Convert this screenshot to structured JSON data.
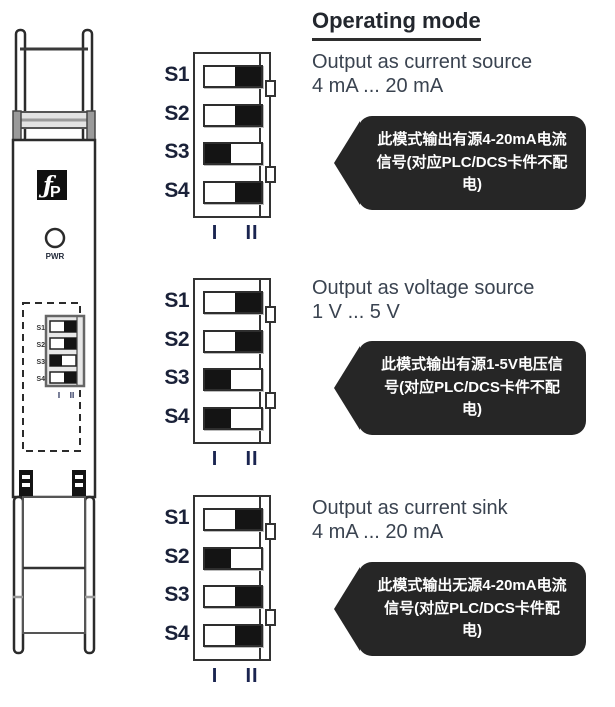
{
  "header": {
    "title": "Operating mode"
  },
  "device": {
    "pwr_label": "PWR",
    "logo_glyphs": {
      "f": "ƒ",
      "p": "P"
    },
    "switch_labels": [
      "S1",
      "S2",
      "S3",
      "S4"
    ],
    "positions": [
      "II",
      "II",
      "I",
      "II"
    ],
    "position_labels": [
      "I",
      "II"
    ]
  },
  "blocks": [
    {
      "rows": [
        {
          "label": "S1",
          "position": "II"
        },
        {
          "label": "S2",
          "position": "II"
        },
        {
          "label": "S3",
          "position": "I"
        },
        {
          "label": "S4",
          "position": "II"
        }
      ],
      "pos_labels": [
        "I",
        "II"
      ]
    },
    {
      "rows": [
        {
          "label": "S1",
          "position": "II"
        },
        {
          "label": "S2",
          "position": "II"
        },
        {
          "label": "S3",
          "position": "I"
        },
        {
          "label": "S4",
          "position": "I"
        }
      ],
      "pos_labels": [
        "I",
        "II"
      ]
    },
    {
      "rows": [
        {
          "label": "S1",
          "position": "II"
        },
        {
          "label": "S2",
          "position": "I"
        },
        {
          "label": "S3",
          "position": "II"
        },
        {
          "label": "S4",
          "position": "II"
        }
      ],
      "pos_labels": [
        "I",
        "II"
      ]
    }
  ],
  "sections": [
    {
      "title_line1": "Output as current source",
      "title_line2": "4 mA ... 20 mA",
      "bubble_lines": [
        "此模式输出有源4-20mA电流",
        "信号(对应PLC/DCS卡件不配",
        "电)"
      ]
    },
    {
      "title_line1": "Output as voltage source",
      "title_line2": "1 V ... 5 V",
      "bubble_lines": [
        "此模式输出有源1-5V电压信",
        "号(对应PLC/DCS卡件不配",
        "电)"
      ]
    },
    {
      "title_line1": "Output as current sink",
      "title_line2": "4 mA ... 20 mA",
      "bubble_lines": [
        "此模式输出无源4-20mA电流",
        "信号(对应PLC/DCS卡件配",
        "电)"
      ]
    }
  ],
  "colors": {
    "line": "#2b2b2b",
    "label_text": "#1a2138",
    "title_text": "#3a4350",
    "bubble_bg": "#262626",
    "bubble_text": "#ffffff",
    "knob": "#141414"
  }
}
